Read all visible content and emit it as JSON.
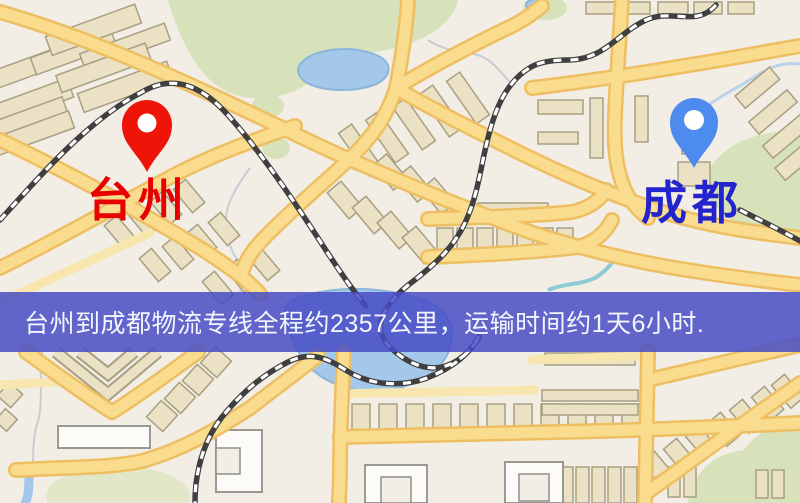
{
  "map": {
    "origin": {
      "name": "台州",
      "pin": "red-map-pin"
    },
    "destination": {
      "name": "成都",
      "pin": "blue-map-pin"
    },
    "banner": {
      "text": "台州到成都物流专线全程约2357公里，运输时间约1天6小时."
    }
  },
  "palette": {
    "map-bg": "#f2eee5",
    "road-fill": "#f9dc8e",
    "road-casing": "#eebf62",
    "road-minor": "#f7e7ae",
    "green": "#d7e2ba",
    "green-pale": "#e2e7c9",
    "water": "#a3c8ea",
    "water-edge": "#8cb5da",
    "stream": "#c6cdd3",
    "stream-blue": "#b9d4ea",
    "stream-teal": "#8ecbd4",
    "building": "#ebe2c6",
    "building-stroke": "#a89f82",
    "building-white": "#fcfbf7",
    "rail-dark": "#3f3f3f",
    "rail-light": "#ffffff",
    "pin-origin": "#ee1408",
    "pin-dest": "#4e8bee",
    "label-origin": "#e80000",
    "label-dest": "#2424cc",
    "banner-bg": "rgba(72,76,197,0.85)",
    "banner-text": "#f4f5fd"
  }
}
